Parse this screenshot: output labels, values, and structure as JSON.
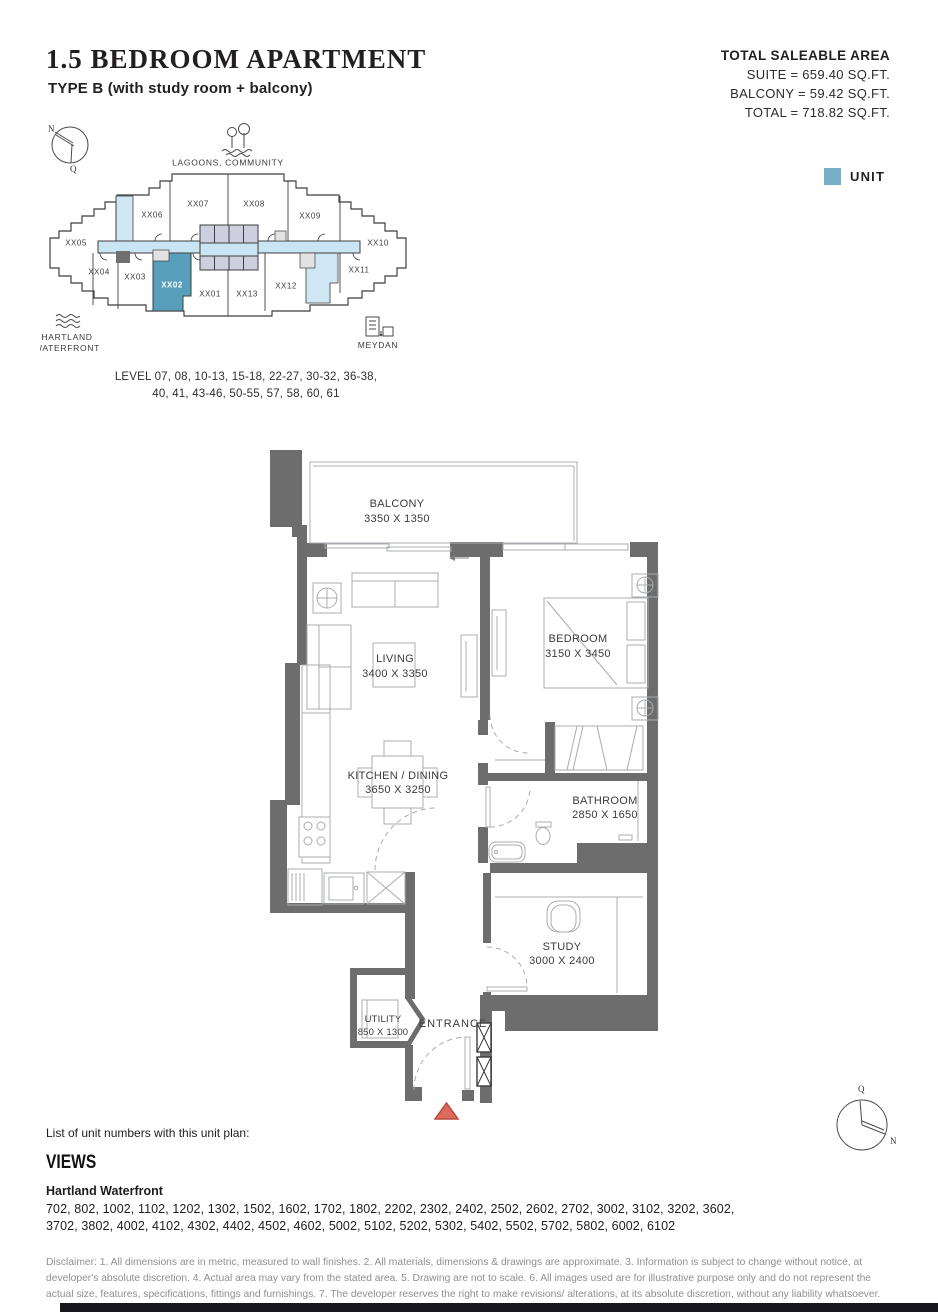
{
  "header": {
    "title": "1.5 BEDROOM APARTMENT",
    "subtitle": "TYPE B (with study room + balcony)",
    "area": {
      "heading": "TOTAL SALEABLE AREA",
      "suite": "SUITE = 659.40 SQ.FT.",
      "balcony": "BALCONY = 59.42 SQ.FT.",
      "total": "TOTAL = 718.82 SQ.FT."
    },
    "legend": {
      "label": "UNIT"
    }
  },
  "keyplan": {
    "compass": {
      "n": "N",
      "q": "Q"
    },
    "landmarks": {
      "top": "LAGOONS, COMMUNITY",
      "bottom_left_line1": "HARTLAND",
      "bottom_left_line2": "WATERFRONT",
      "bottom_right": "MEYDAN"
    },
    "units": [
      "XX05",
      "XX06",
      "XX07",
      "XX08",
      "XX09",
      "XX10",
      "XX04",
      "XX03",
      "XX02",
      "XX01",
      "XX13",
      "XX12",
      "XX11"
    ],
    "highlighted_unit": "XX02",
    "levels_line1": "LEVEL 07, 08, 10-13, 15-18, 22-27, 30-32, 36-38,",
    "levels_line2": "40, 41, 43-46, 50-55, 57, 58, 60, 61"
  },
  "floorplan": {
    "rooms": [
      {
        "name": "BALCONY",
        "dims": "3350 X 1350"
      },
      {
        "name": "LIVING",
        "dims": "3400 X 3350"
      },
      {
        "name": "BEDROOM",
        "dims": "3150 X 3450"
      },
      {
        "name": "KITCHEN / DINING",
        "dims": "3650 X 3250"
      },
      {
        "name": "BATHROOM",
        "dims": "2850 X 1650"
      },
      {
        "name": "STUDY",
        "dims": "3000 X 2400"
      },
      {
        "name": "UTILITY",
        "dims": "850 X 1300"
      }
    ],
    "entrance_label": "ENTRANCE"
  },
  "footer": {
    "list_heading": "List of unit numbers with this unit plan:",
    "views_heading": "VIEWS",
    "view_name": "Hartland Waterfront",
    "unit_numbers": "702, 802, 1002, 1102, 1202, 1302, 1502, 1602, 1702, 1802, 2202, 2302, 2402, 2502, 2602, 2702, 3002, 3102, 3202, 3602, 3702, 3802, 4002, 4102, 4302, 4402, 4502, 4602, 5002, 5102, 5202, 5302, 5402, 5502, 5702, 5802, 6002, 6102",
    "disclaimer": "Disclaimer: 1. All dimensions are in metric, measured to wall finishes. 2. All materials, dimensions & drawings are approximate. 3. Information is subject to change without notice, at developer's absolute discretion. 4. Actual area may vary from the stated area. 5. Drawing are not to scale. 6. All images used are for illustrative purpose only and do not represent the actual size, features, specifications, fittings and furnishings. 7. The developer reserves the right to make revisions/ alterations, at its absolute discretion, without any liability whatsoever."
  },
  "icons": {
    "compass-top-left": "circle with N/Q needle",
    "lagoons-icon": "trees over water",
    "waves-icon": "three wavy lines",
    "meydan-icon": "small buildings",
    "entrance-marker": "red triangle",
    "compass-bottom-right": "circle with Q/N needle"
  },
  "colors": {
    "unit_legend": "#76aec5",
    "unit_highlight": "#579fba",
    "corridor_blue": "#c9e4f2",
    "core_lavender": "#cdcede",
    "wall_gray": "#6d6d6d",
    "furniture_gray": "#a8acb0",
    "triangle_red": "#dd6a5d"
  }
}
